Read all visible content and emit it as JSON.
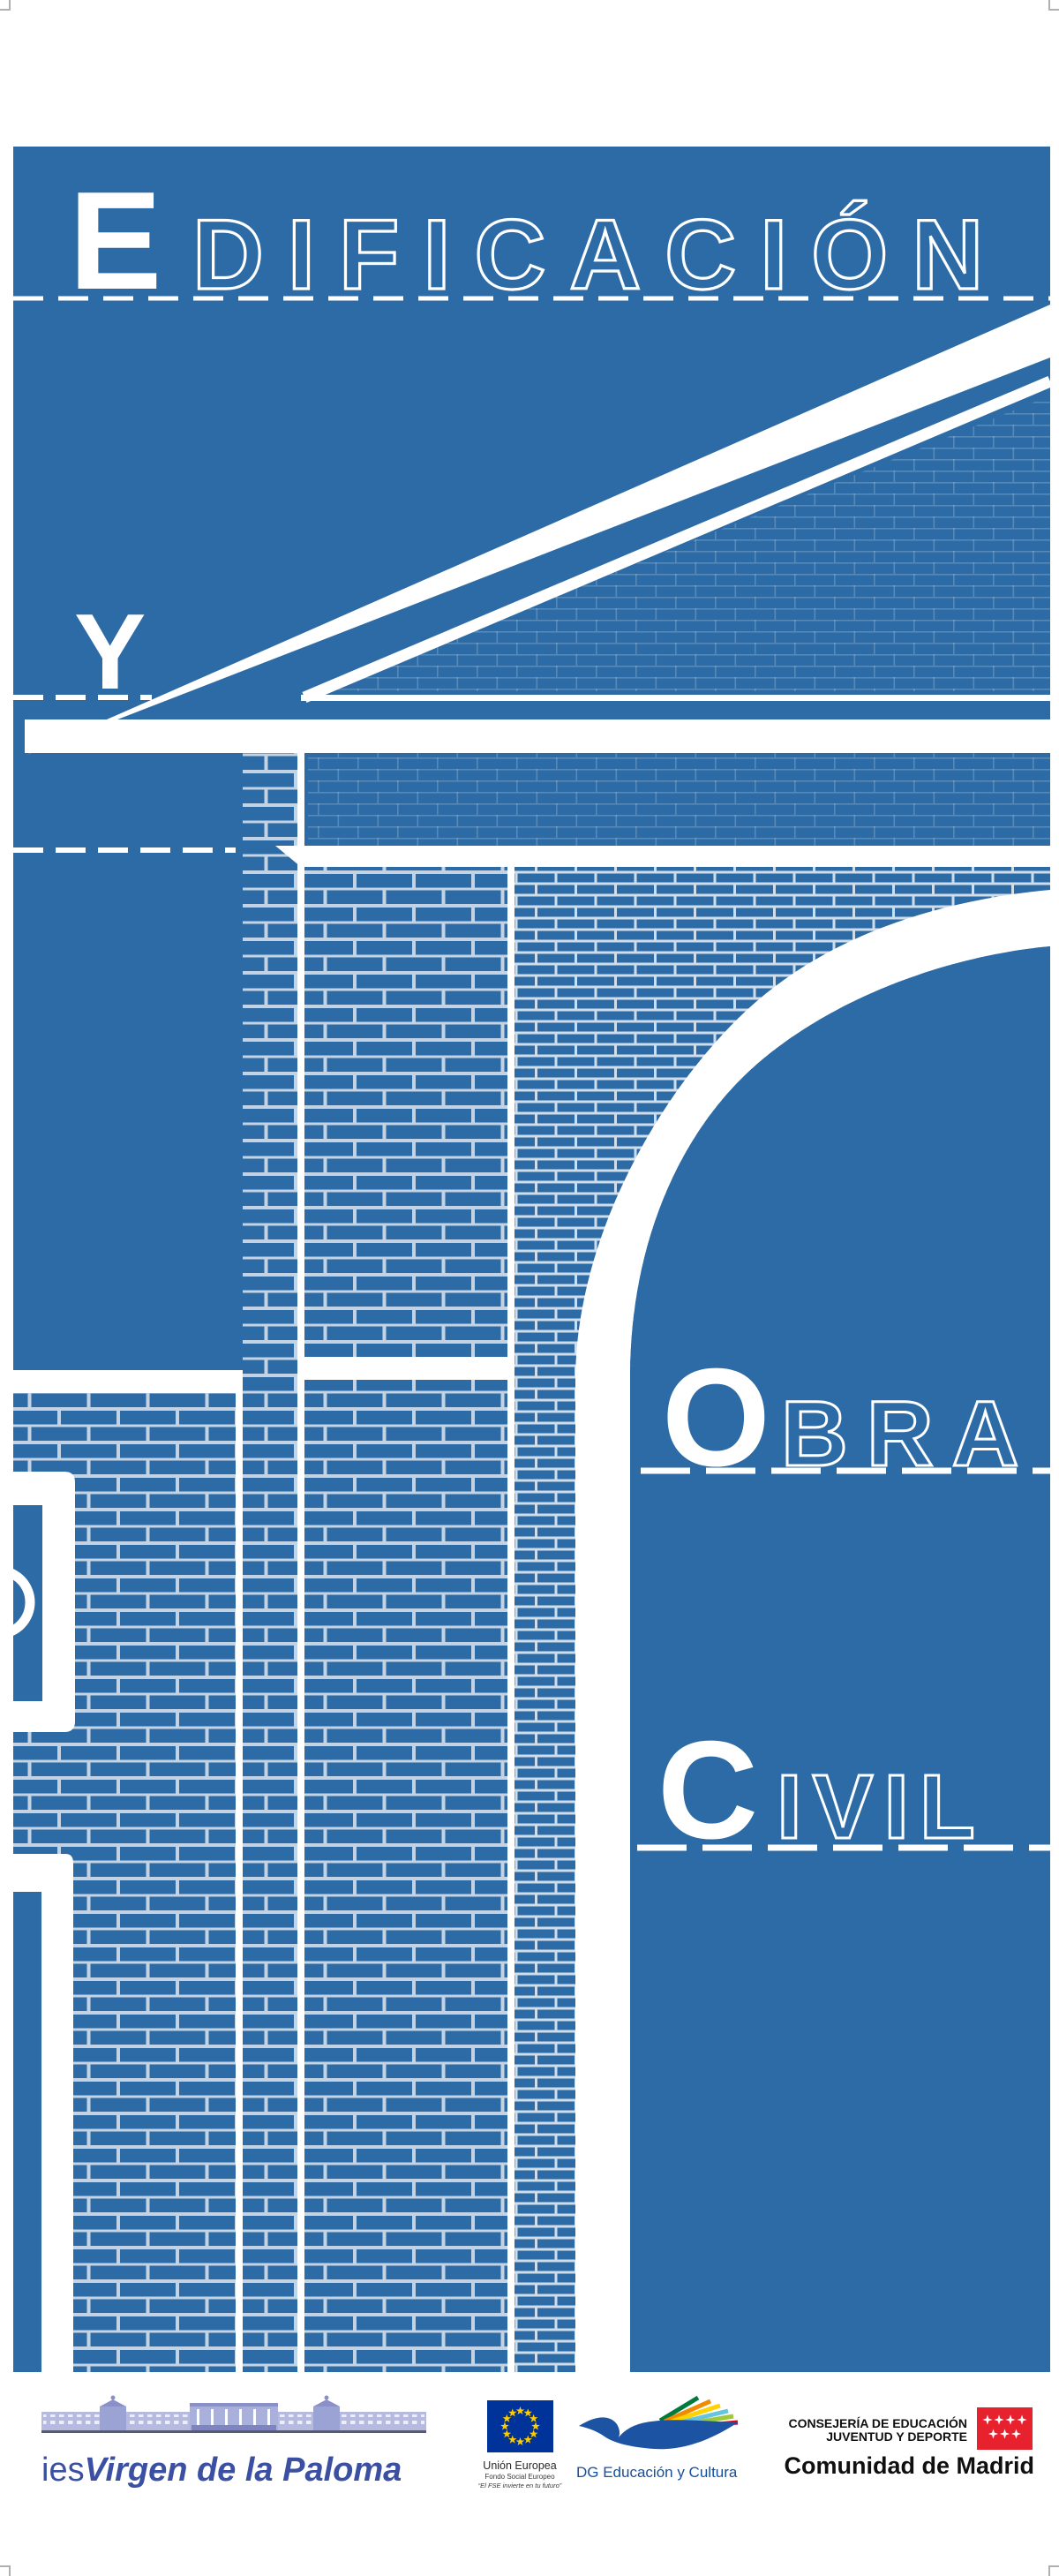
{
  "poster": {
    "word1_initial": "E",
    "word1_rest": "DIFICACIÓN",
    "conjunction": "Y",
    "word2_initial": "O",
    "word2_rest": "BRA",
    "word3_initial": "C",
    "word3_rest": "IVIL",
    "background_color": "#2d6ba6",
    "line_color": "#ffffff"
  },
  "footer": {
    "school": {
      "prefix": "ies",
      "name": "Virgen de la Paloma",
      "text_color": "#3b50a2"
    },
    "eu": {
      "org": "Unión Europea",
      "fund": "Fondo Social Europeo",
      "motto": "“El FSE invierte en tu futuro”",
      "flag_blue": "#003399",
      "star_yellow": "#ffcc00"
    },
    "dg": {
      "label": "DG Educación y Cultura",
      "bird_blue": "#1c53a3",
      "ribbon_colors": [
        "#007b3d",
        "#f08a00",
        "#ffd300",
        "#66c5de",
        "#9cca3b",
        "#e2001a"
      ]
    },
    "madrid": {
      "dept_line1": "CONSEJERÍA DE EDUCACIÓN",
      "dept_line2": "JUVENTUD Y DEPORTE",
      "name": "Comunidad de Madrid",
      "flag_red": "#e8212e"
    }
  }
}
